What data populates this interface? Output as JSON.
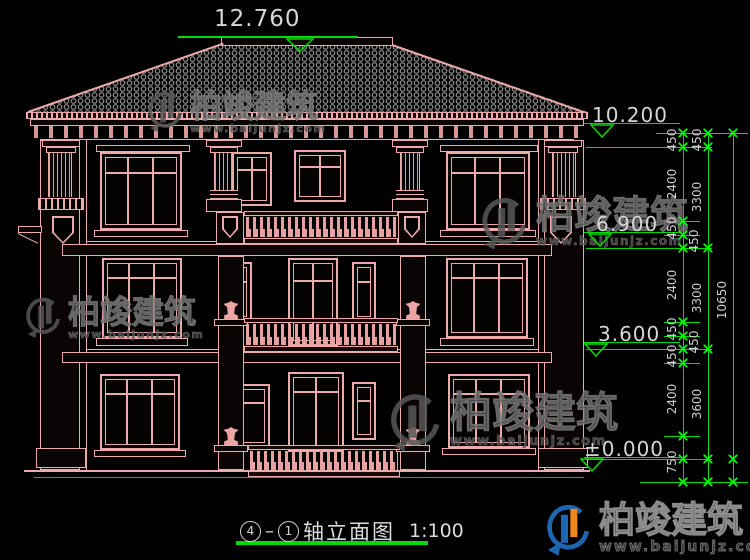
{
  "drawing": {
    "title": {
      "axis_start": "4",
      "axis_end": "1",
      "name": "轴立面图",
      "scale": "1:100"
    },
    "top_dimension": {
      "value": "12.760"
    },
    "elevation_markers": [
      {
        "value": "10.200"
      },
      {
        "value": "6.900"
      },
      {
        "value": "3.600"
      },
      {
        "value": "±0.000"
      }
    ],
    "dimension_chains": {
      "inner": [
        "450",
        "2400",
        "450",
        "450",
        "2400",
        "450",
        "450",
        "450",
        "2400",
        "750"
      ],
      "middle": [
        "450",
        "3300",
        "3300",
        "3600"
      ],
      "overall": [
        "10650"
      ]
    },
    "colors": {
      "line": "#edaaaa",
      "dimension_green": "#00dc00",
      "text": "#d6d6d6",
      "background": "#000000"
    }
  },
  "watermark": {
    "brand": "柏竣建筑",
    "url": "www.baijunjz.com"
  },
  "brand_footer": {
    "name": "柏竣建筑",
    "url": "www.baijunjz.com",
    "logo_blue": "#1f66b0",
    "logo_orange": "#f08519"
  }
}
